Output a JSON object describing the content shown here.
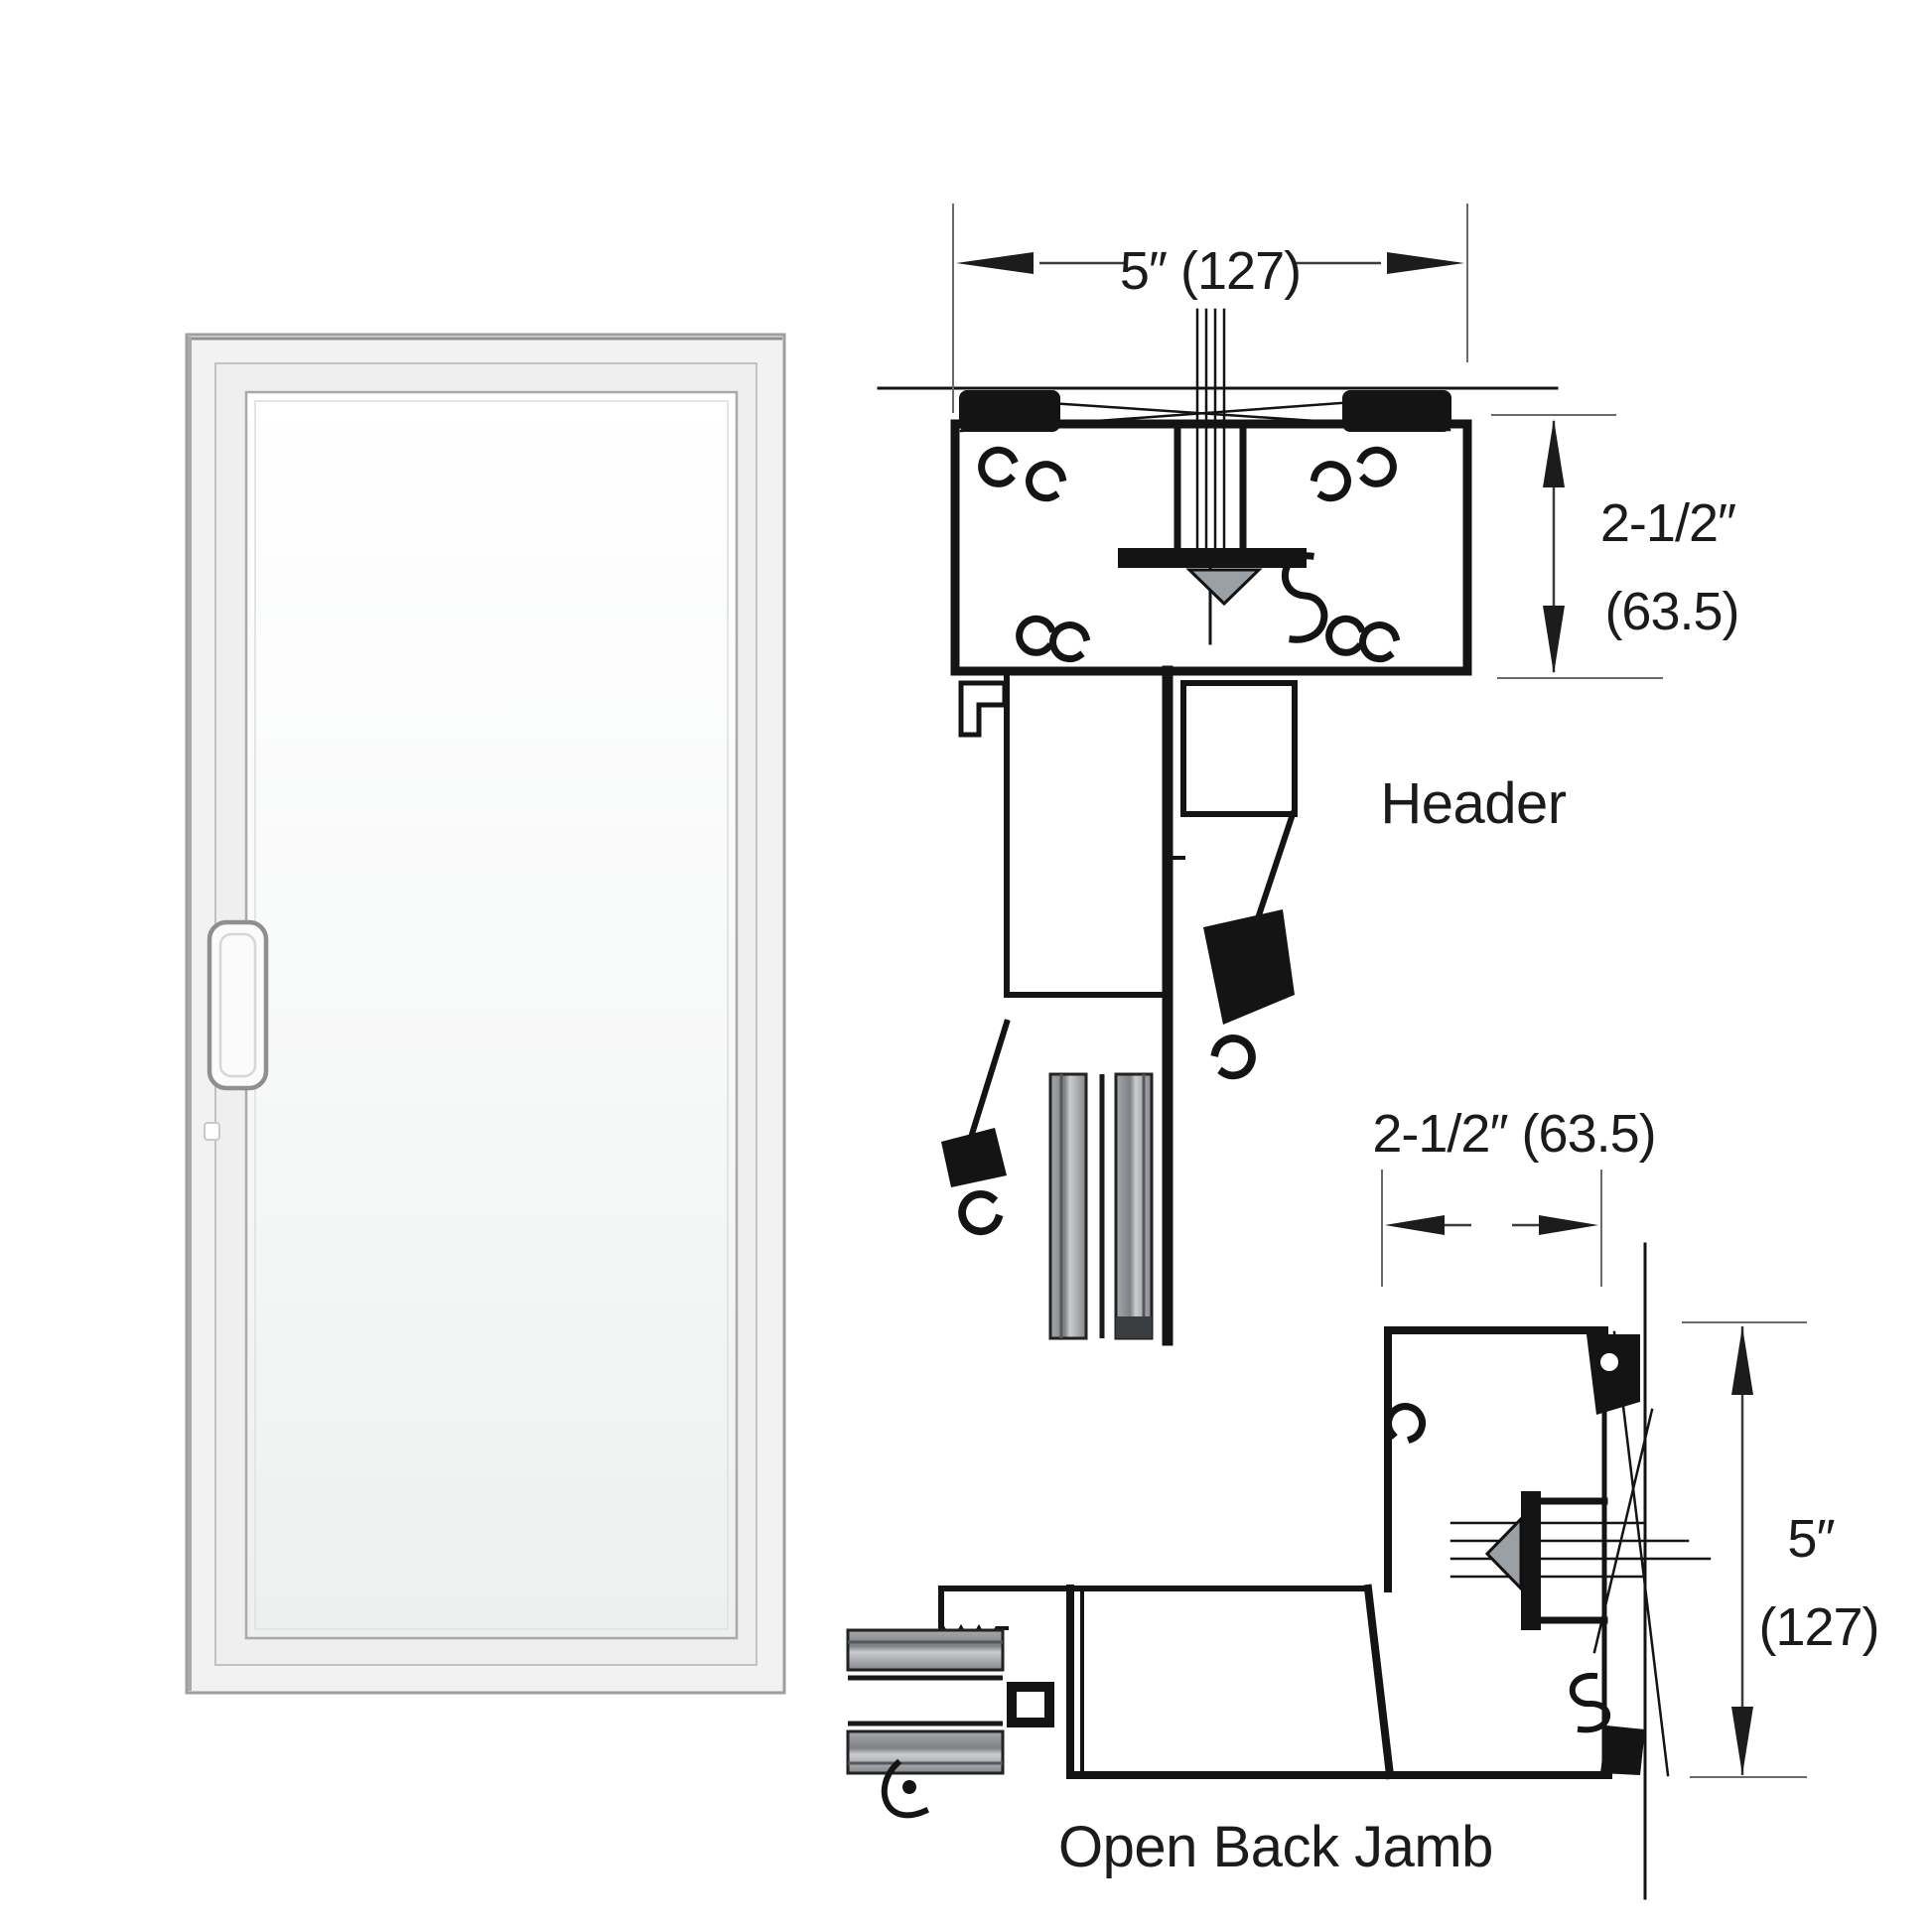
{
  "sections": {
    "door_photo": {
      "description": "white aluminum framed glass door with offset pull handle"
    },
    "header": {
      "label": "Header",
      "width_dim": "5″ (127)",
      "height_dim_line1": "2-1/2″",
      "height_dim_line2": "(63.5)"
    },
    "jamb": {
      "label": "Open Back Jamb",
      "width_dim": "2-1/2″ (63.5)",
      "height_dim_line1": "5″",
      "height_dim_line2": "(127)"
    }
  },
  "colors": {
    "background": "#ffffff",
    "drawing_line": "#141414",
    "dimension_line": "#3c3c3c",
    "door_frame": "#f2f2f2",
    "door_frame_edge": "#9e9e9e",
    "door_glass": "#fafbfb",
    "gray_bar": "#8d8f91",
    "wedge": "#9aa0a3"
  }
}
